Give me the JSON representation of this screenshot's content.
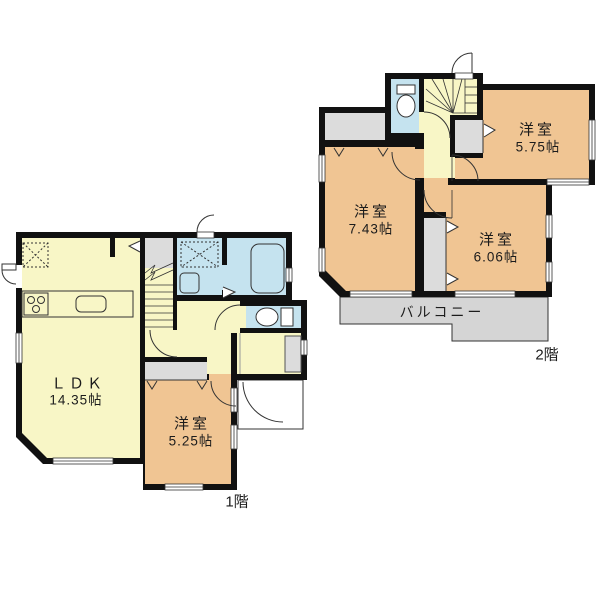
{
  "document_type": "間取り図",
  "floors": [
    {
      "name": "1階",
      "rooms": [
        {
          "label": "ＬＤＫ",
          "area": "14.35帖"
        },
        {
          "label": "洋室",
          "area": "5.25帖"
        }
      ]
    },
    {
      "name": "2階",
      "rooms": [
        {
          "label": "洋室",
          "area": "7.43帖"
        },
        {
          "label": "洋室",
          "area": "6.06帖"
        },
        {
          "label": "洋室",
          "area": "5.75帖"
        },
        {
          "label": "バルコニー",
          "area": ""
        }
      ]
    }
  ],
  "colors": {
    "wall": "#111111",
    "living_fill": "#F8F6C6",
    "tatami_room_fill": "#F0C593",
    "wet_area_fill": "#C5E3EF",
    "closet_fill": "#DCDCDC",
    "balcony_fill": "#D5D5D5"
  }
}
